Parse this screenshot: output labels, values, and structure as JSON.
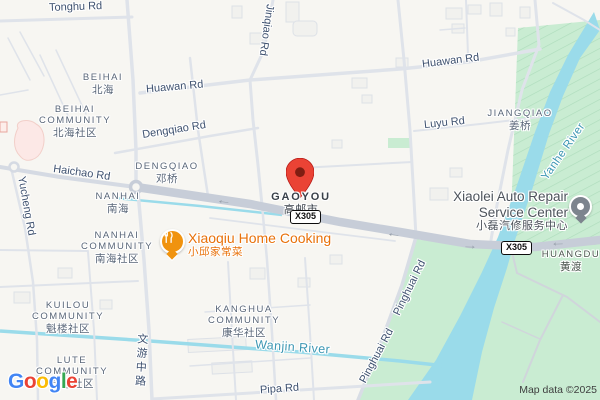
{
  "colors": {
    "land": "#f7f6f2",
    "water": "#9adbea",
    "park_green": "#c9ecd2",
    "main_road": "#c7cdd8",
    "minor_road": "#dfe3ea",
    "road_label": "#3e516f",
    "water_label": "#3d97b3",
    "area_label": "#596678",
    "poi_orange": "#e8710a",
    "pin_red": "#EA4335",
    "pin_gray": "#7d848e",
    "aoi_pink": "#fce8e6"
  },
  "city": {
    "en": "GAOYOU",
    "zh": "高邮市"
  },
  "route_badge": "X305",
  "roads": {
    "tonghu": "Tonghu Rd",
    "jinqiao": "Jinqiao Rd",
    "huawan": "Huawan Rd",
    "dengqiao": "Dengqiao Rd",
    "haichao": "Haichao Rd",
    "yucheng": "Yucheng Rd",
    "luyu": "Luyu Rd",
    "wenyou": "文游中路",
    "pinghuai": "Pinghuai Rd",
    "pipa": "Pipa Rd"
  },
  "waters": {
    "yanhe": "Yanhe River",
    "wanjin": "Wanjin River"
  },
  "areas": [
    {
      "en": "BEIHAI",
      "zh": "北海"
    },
    {
      "en": "BEIHAI COMMUNITY",
      "zh": "北海社区"
    },
    {
      "en": "DENGQIAO",
      "zh": "邓桥"
    },
    {
      "en": "NANHAI",
      "zh": "南海"
    },
    {
      "en": "NANHAI COMMUNITY",
      "zh": "南海社区"
    },
    {
      "en": "JIANGQIAO",
      "zh": "姜桥"
    },
    {
      "en": "KUILOU COMMUNITY",
      "zh": "魁楼社区"
    },
    {
      "en": "LUTE COMMUNITY",
      "zh": "琵琶社区"
    },
    {
      "en": "KANGHUA COMMUNITY",
      "zh": "康华社区"
    },
    {
      "en": "HUANGDU",
      "zh": "黄渡"
    }
  ],
  "pois": {
    "restaurant": {
      "name": "Xiaoqiu Home Cooking",
      "name_zh": "小邱家常菜"
    },
    "auto_repair": {
      "line1": "Xiaolei Auto Repair",
      "line2": "Service Center",
      "name_zh": "小磊汽修服务中心"
    }
  },
  "icons": {
    "one_way_left": "←",
    "one_way_right": "→"
  },
  "attribution": {
    "map_data": "Map data ©2025",
    "logo": [
      "G",
      "o",
      "o",
      "g",
      "l",
      "e"
    ]
  }
}
